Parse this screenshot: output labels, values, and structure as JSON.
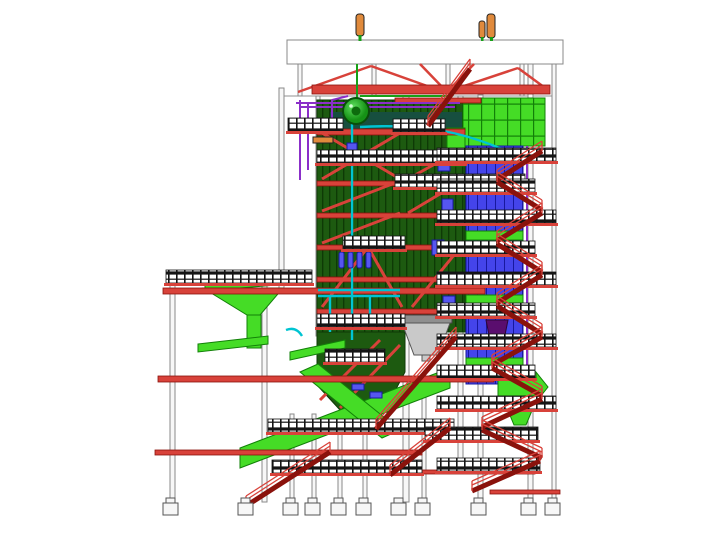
{
  "figure": {
    "type": "cad-elevation-drawing",
    "description": "3D CAD side-elevation of a power plant boiler island with furnace, rear gas pass, platforms, stairs and conveyors",
    "background": "#ffffff"
  },
  "colors": {
    "structure_red": "#d8423a",
    "structure_red_dark": "#8a120c",
    "railing_black": "#141414",
    "furnace_dark_green": "#1d5a10",
    "furnace_dark_green_edge": "#0e3a06",
    "bright_green": "#45dc26",
    "bright_green_dark": "#128008",
    "duct_blue": "#4444ea",
    "duct_blue_dark": "#18189e",
    "panel_blue": "#5656f0",
    "pipe_purple": "#8b2fc9",
    "hopper_purple": "#5a0e6e",
    "pipe_cyan": "#00c4d2",
    "pipe_green": "#17a017",
    "silencer_orange": "#e08a3c",
    "column_white": "#f7f7f7",
    "column_stroke": "#8a8a8a",
    "ash_hopper_gray": "#c9c9c9",
    "ash_hopper_gray_dark": "#8f8f8f",
    "teal_dark": "#174f3f",
    "outline_gray": "#909090"
  }
}
